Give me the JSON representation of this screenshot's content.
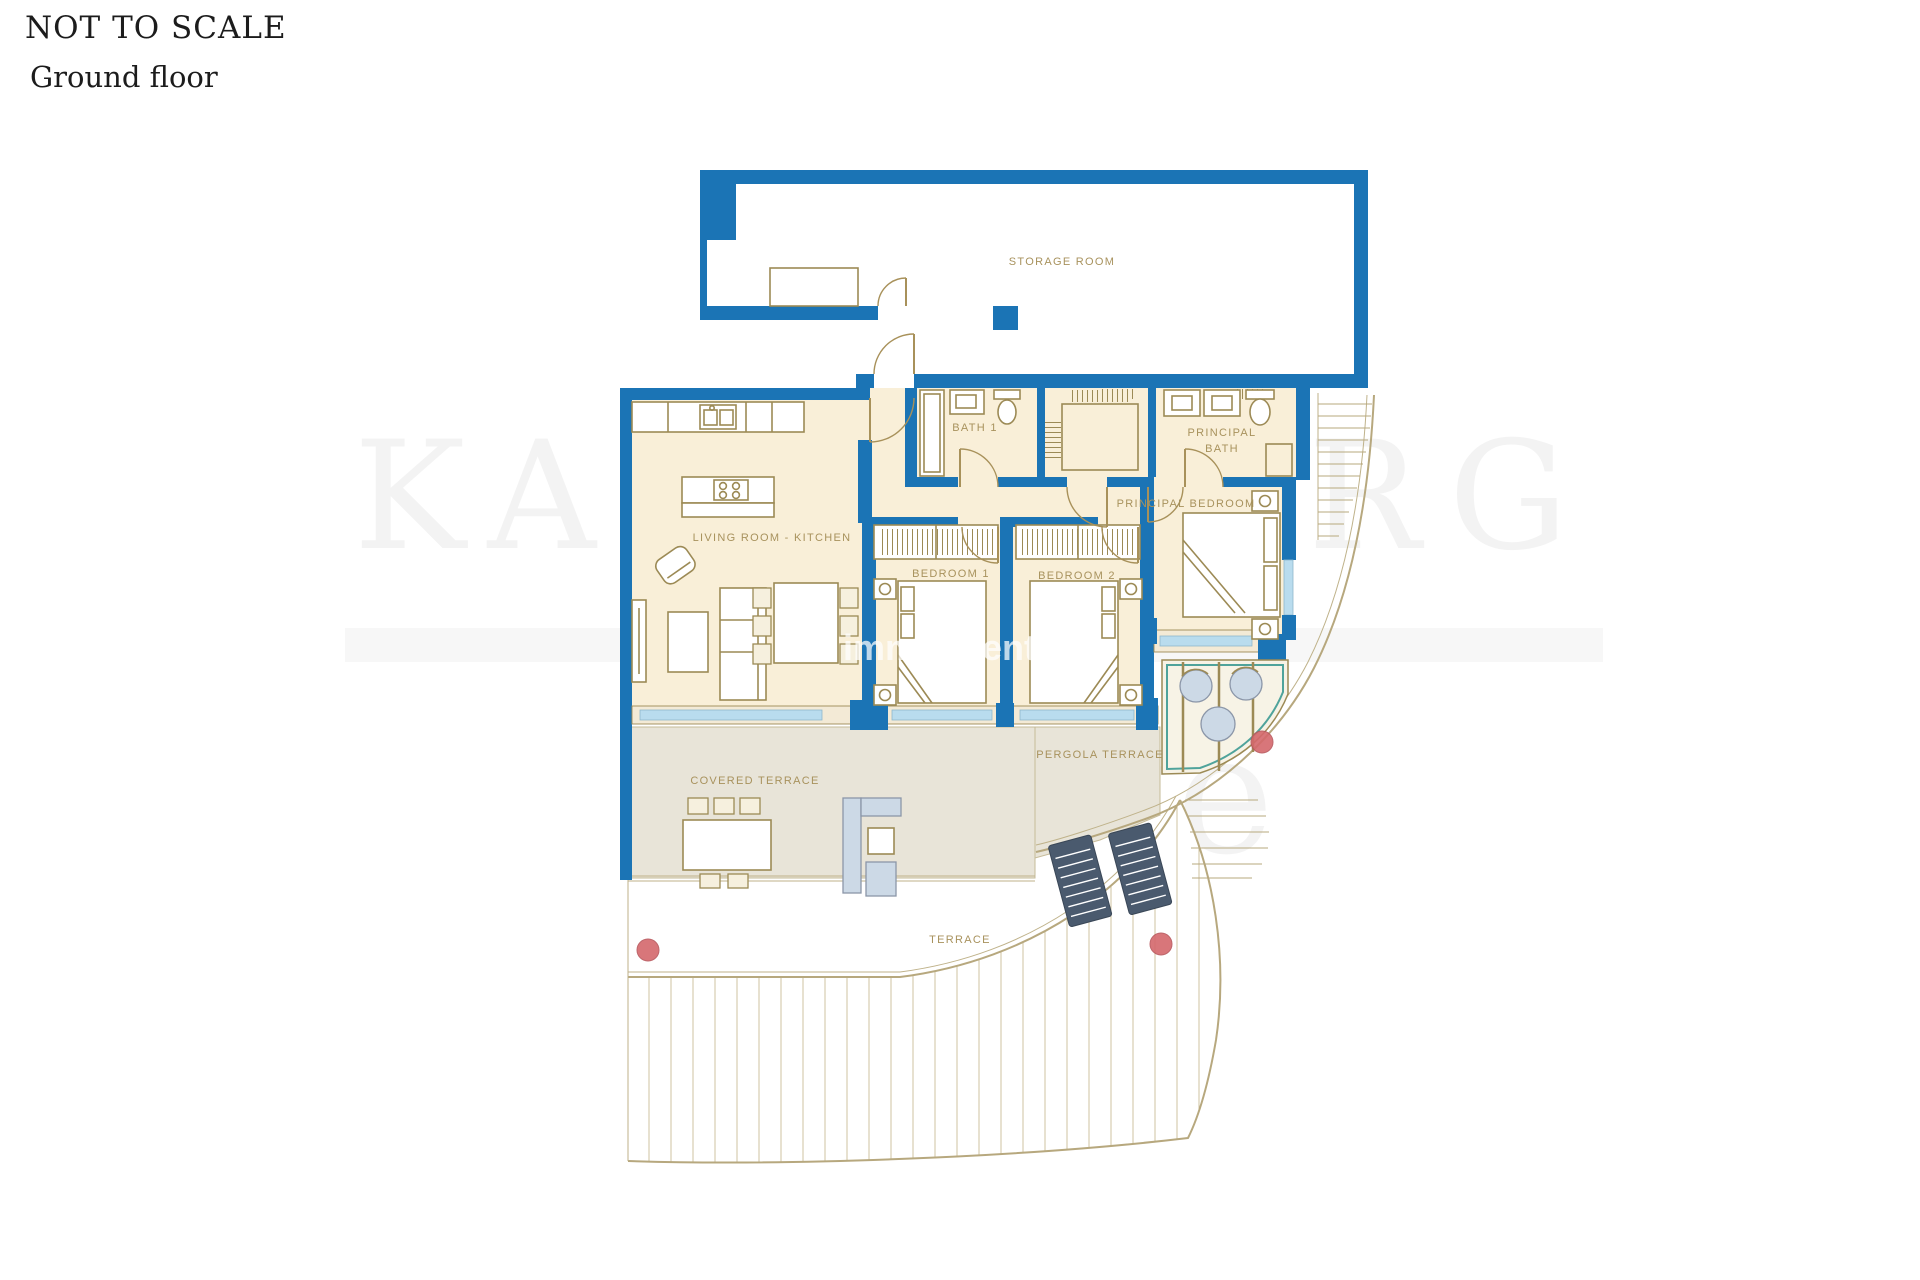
{
  "header": {
    "note": "NOT TO SCALE",
    "floor": "Ground floor"
  },
  "watermark": {
    "brand": "KAARSBERG",
    "brand2": "Estate",
    "overlay_left": "immo",
    "overlay_right": "ment.e"
  },
  "rooms": {
    "storage": "STORAGE ROOM",
    "bath1": "BATH 1",
    "principal_bath_1": "PRINCIPAL",
    "principal_bath_2": "BATH",
    "living_kitchen": "LIVING ROOM - KITCHEN",
    "bedroom1": "BEDROOM 1",
    "bedroom2": "BEDROOM 2",
    "principal_bedroom": "PRINCIPAL BEDROOM",
    "covered_terrace": "COVERED TERRACE",
    "pergola_terrace": "PERGOLA TERRACE",
    "terrace": "TERRACE"
  },
  "colors": {
    "wall_blue": "#1b74b5",
    "room_cream": "#f9efd8",
    "terrace_grey": "#e8e4d8",
    "furniture_tan": "#9c8a55",
    "label_tan": "#a8925d",
    "glass_blue": "#b9dcee",
    "teal_accent": "#4fa39b",
    "plant_red": "#d4686c",
    "lounger_navy": "#4a5a6e"
  }
}
